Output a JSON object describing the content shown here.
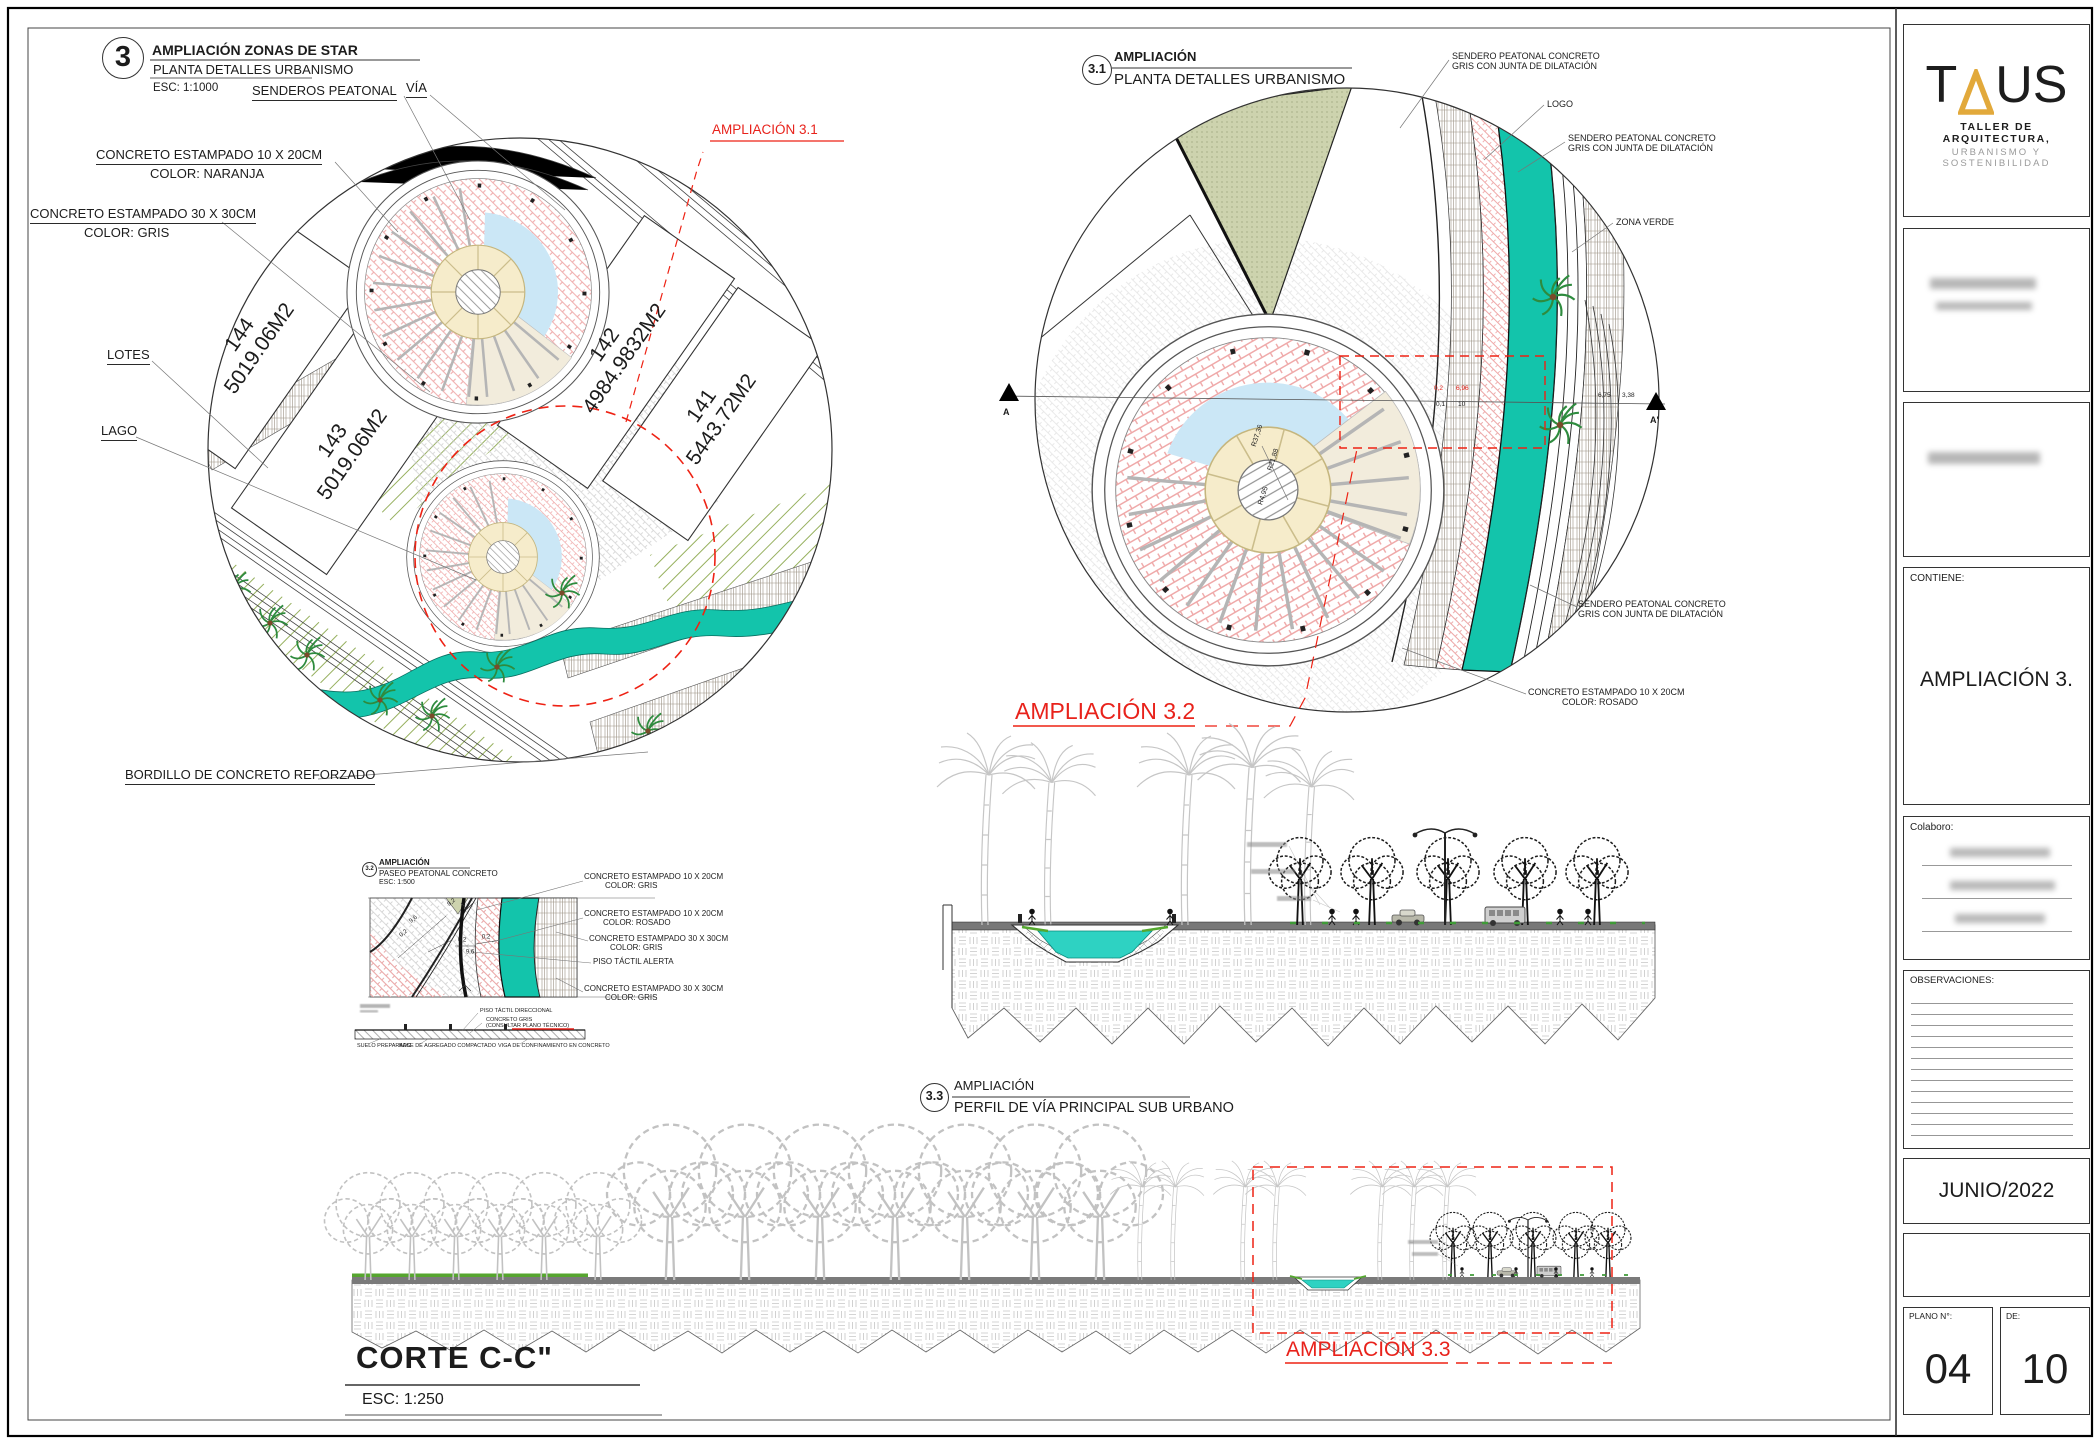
{
  "colors": {
    "accent_red": "#E8221B",
    "teal": "#13C4AB",
    "lake_blue": "#CBE7F6",
    "pink_paver": "#EFA9A9",
    "olive": "#CDD3AE",
    "logo_gold": "#E2A93B"
  },
  "d3": {
    "num": "3",
    "title": "AMPLIACIÓN  ZONAS DE STAR",
    "subtitle": "PLANTA DETALLES URBANISMO",
    "scale": "ESC: 1:1000",
    "senderos": "SENDEROS PEATONAL",
    "via": "VÍA",
    "conc1a": "CONCRETO ESTAMPADO 10 X 20CM",
    "conc1b": "COLOR:    NARANJA",
    "conc2a": "CONCRETO ESTAMPADO 30 X 30CM",
    "conc2b": "COLOR:    GRIS",
    "lotes": "LOTES",
    "lago": "LAGO",
    "bordillo": "BORDILLO DE CONCRETO REFORZADO",
    "ref": "AMPLIACIÓN 3.1",
    "lots": [
      {
        "num": "144",
        "area": "5019.06M2"
      },
      {
        "num": "143",
        "area": "5019.06M2"
      },
      {
        "num": "142",
        "area": "4984.9832M2"
      },
      {
        "num": "141",
        "area": "5443.72M2"
      }
    ]
  },
  "d31": {
    "num": "3.1",
    "title": "AMPLIACIÓN",
    "subtitle": "PLANTA DETALLES URBANISMO",
    "send1": "SENDERO PEATONAL CONCRETO",
    "send2": "GRIS CON JUNTA DE DILATACIÓN",
    "logo": "LOGO",
    "zona": "ZONA VERDE",
    "rosa1": "CONCRETO ESTAMPADO 10 X 20CM",
    "rosa2": "COLOR:    ROSADO",
    "r1": "R37,36",
    "r2": "R21,88",
    "r3": "R4,95",
    "dimr1": "0,2",
    "dimr2": "6,96",
    "dimb1": "0,1",
    "dimb2": "10",
    "dimb3": "6,75",
    "dimb4": "3,38",
    "a": "A",
    "a2": "A'",
    "ref": "AMPLIACIÓN 3.2"
  },
  "d32": {
    "num": "3.2",
    "title": "AMPLIACIÓN",
    "subtitle": "PASEO PEATONAL CONCRETO",
    "scale": "ESC: 1:500",
    "l1a": "CONCRETO ESTAMPADO 10 X 20CM",
    "l1b": "COLOR:    GRIS",
    "l2a": "CONCRETO ESTAMPADO 10 X 20CM",
    "l2b": "COLOR:    ROSADO",
    "l3a": "CONCRETO ESTAMPADO 30 X 30CM",
    "l3b": "COLOR:    GRIS",
    "l4": "PISO TÁCTIL ALERTA",
    "l5a": "CONCRETO ESTAMPADO 30 X 30CM",
    "l5b": "COLOR:    GRIS",
    "d1": "9,2",
    "d2": "9,6",
    "d3": "0,2",
    "d4": "0,2",
    "d5": "0,2",
    "d6": "9,6",
    "s1": "PISO TÁCTIL DIRECCIONAL",
    "s2": "CONCRETO GRIS",
    "s3": "(CONSULTAR PLANO TÉCNICO)",
    "s4": "SUELO PREPARADO",
    "s5": "BASE DE AGREGADO COMPACTADO",
    "s6": "VIGA DE CONFINAMIENTO EN CONCRETO"
  },
  "d33": {
    "num": "3.3",
    "title": "AMPLIACIÓN",
    "subtitle": "PERFIL DE VÍA PRINCIPAL SUB URBANO",
    "ref": "AMPLIACIÓN 3.3"
  },
  "corte": {
    "title": "CORTE C-C\"",
    "scale": "ESC: 1:250"
  },
  "tb": {
    "logo_t": "T",
    "logo_us": "US",
    "logo_l1": "TALLER DE ARQUITECTURA,",
    "logo_l2": "URBANISMO Y SOSTENIBILIDAD",
    "contiene": "CONTIENE:",
    "contiene_val": "AMPLIACIÓN 3.",
    "colaboro": "Colaboro:",
    "obs": "OBSERVACIONES:",
    "fecha": "JUNIO/2022",
    "plano": "PLANO N°:",
    "plano_val": "04",
    "de": "DE:",
    "de_val": "10"
  }
}
